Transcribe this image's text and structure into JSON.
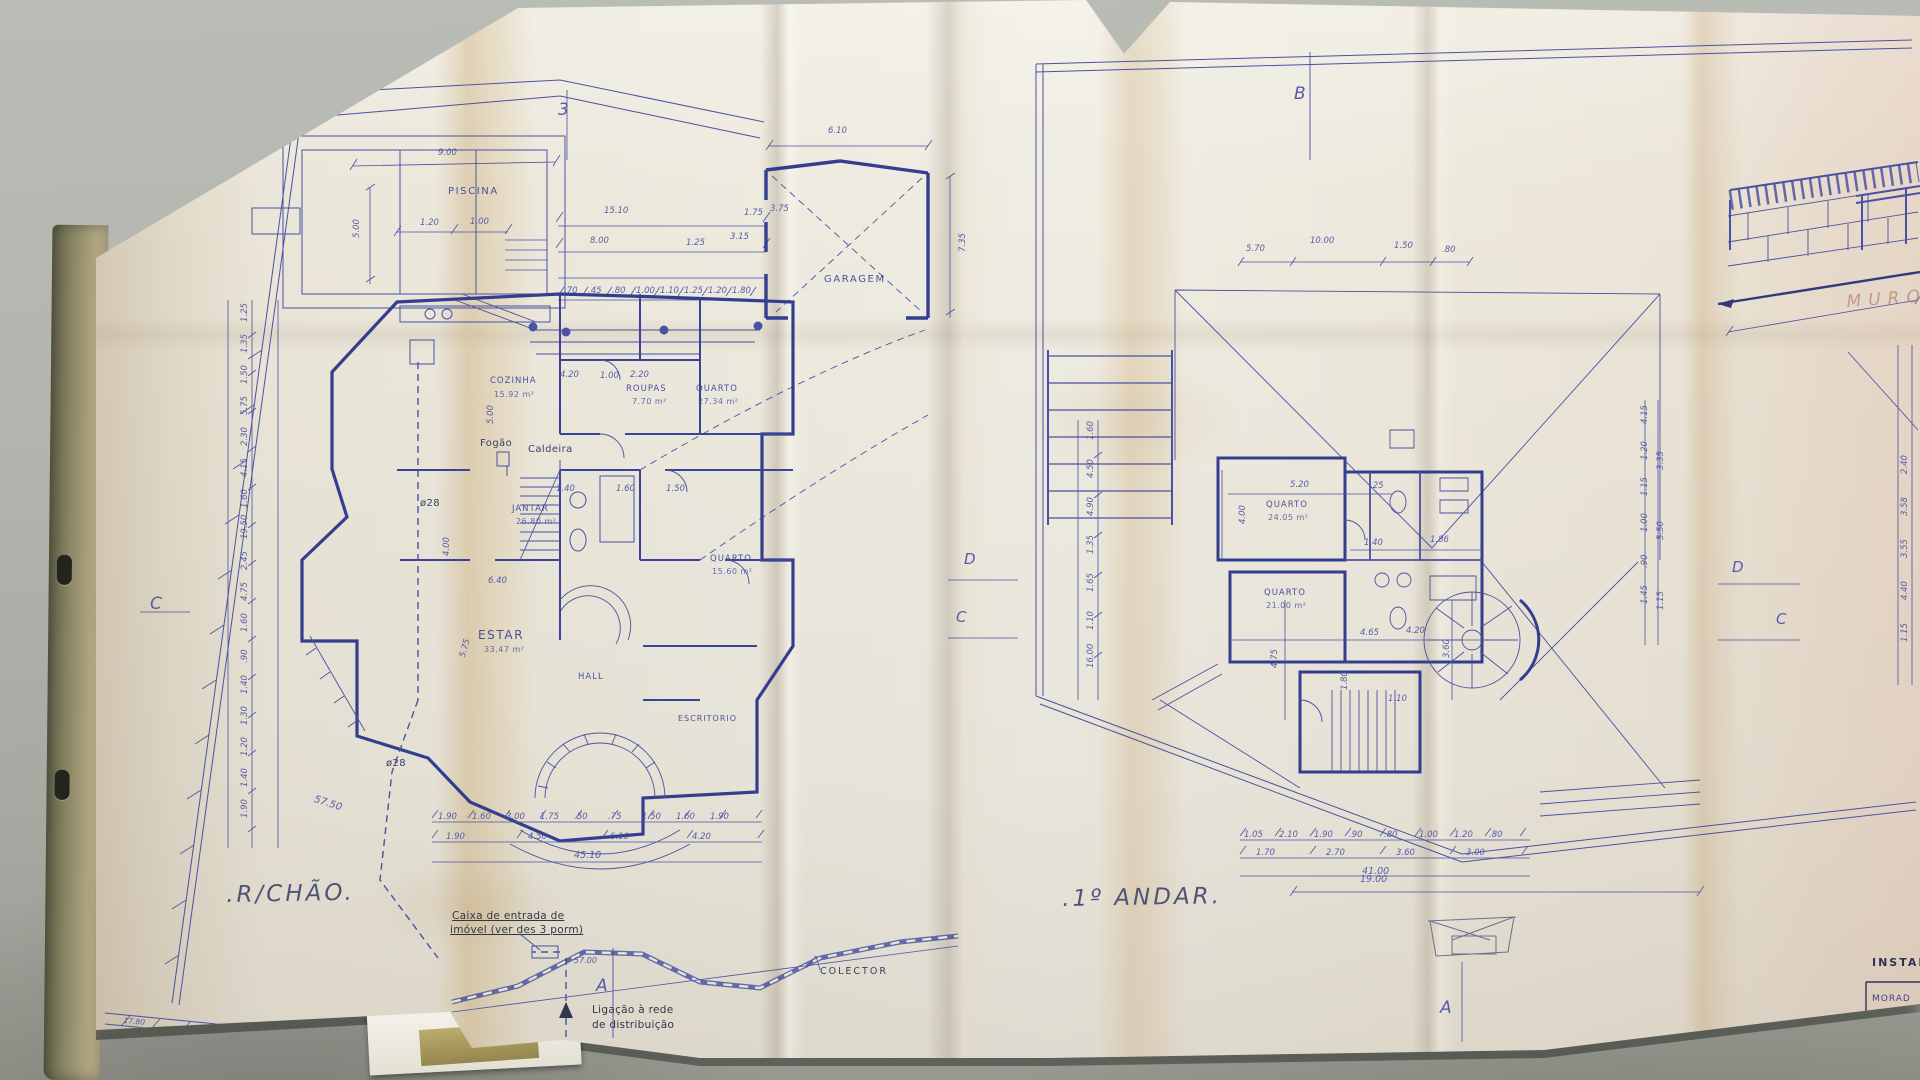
{
  "lp": {
    "title": ".R/CHÃO.",
    "m3": "3",
    "mc": "C",
    "ma": "A",
    "piscina": "PISCINA",
    "garagem": "GARAGEM",
    "cozinha": "COZINHA",
    "cozinha_a": "15.92 m²",
    "roupas": "ROUPAS",
    "roupas_a": "7.70 m²",
    "quarto": "QUARTO",
    "quarto_a": "27.34 m²",
    "quarto2": "QUARTO",
    "quarto2_a": "15.60 m²",
    "jantar": "JANTAR",
    "jantar_a": "26.80 m²",
    "estar": "ESTAR",
    "estar_a": "33.47 m²",
    "hall": "HALL",
    "escritorio": "ESCRITORIO",
    "fogao": "Fogão",
    "caldeira": "Caldeira",
    "phi28a": "ø28",
    "phi28b": "ø28",
    "d5750": "57.50",
    "d5700": "57.00",
    "colector": "COLECTOR",
    "caixa1": "Caixa de entrada de",
    "caixa2": "imóvel (ver des 3 porm)",
    "lig1": "Ligação à rede",
    "lig2": "de distribuição",
    "pool_w": "9.00",
    "pool_h": "5.00",
    "pool_c1": "1.20",
    "pool_c2": "1.00",
    "garage_w": "6.10",
    "garage_h": "7.35",
    "t1510": "15.10",
    "t800": "8.00",
    "t125": "1.25",
    "t315": "3.15",
    "t175": "1.75",
    "t375": "3.75",
    "i420": "4.20",
    "i100": "1.00",
    "i220": "2.20",
    "i400": "4.00",
    "i640": "6.40",
    "i140": "1.40",
    "i160": "1.60",
    "i150": "1.50",
    "i575": "5.75",
    "i500": "5.00",
    "total": "45.10",
    "wall": "17.80",
    "chain_left": [
      "1.25",
      "1.35",
      "1.50",
      "5.75",
      "2.30",
      "4.15",
      "1.60",
      "19.50",
      "2.45",
      "4.75",
      "1.60",
      ".90",
      "1.40",
      "1.30",
      "1.20",
      "1.40",
      "1.90"
    ],
    "chain_top": [
      ".70",
      ".45",
      ".80",
      "1.00",
      "1.10",
      "1.25",
      "1.20",
      "1.80"
    ],
    "chain_b1": [
      "1.90",
      "1.60",
      "3.00",
      "1.75",
      ".50",
      ".75",
      "1.50",
      "1.60",
      "1.90"
    ],
    "chain_b2": [
      "1.90",
      "4.50",
      "6.10",
      "4.20"
    ]
  },
  "rp": {
    "title": ".1º ANDAR.",
    "mb": "B",
    "md1": "D",
    "mc1": "C",
    "md2": "D",
    "mc2": "C",
    "ma": "A",
    "quarto1": "QUARTO",
    "quarto1_a": "24.05 m²",
    "quarto2": "QUARTO",
    "quarto2_a": "21.00 m²",
    "t570": "5.70",
    "t1000": "10.00",
    "t150": "1.50",
    "t080": ".80",
    "long": "19.00",
    "i520": "5.20",
    "i025": ".25",
    "i400": "4.00",
    "i140": "1.40",
    "i186": "1.86",
    "i465": "4.65",
    "i420": "4.20",
    "i475": "4.75",
    "i360": "3.60",
    "i180": "1.80",
    "i110": "1.10",
    "total": "41.00",
    "chain_left": [
      "1.60",
      "4.50",
      "4.90",
      "1.35",
      "1.65",
      "1.10",
      "16.00"
    ],
    "chain_r1": [
      "4.15",
      "1.20",
      "1.15",
      "1.00",
      ".90",
      "1.45"
    ],
    "chain_r2": [
      "3.35",
      "5.50",
      "1.15"
    ],
    "chain_far": [
      "2.40",
      "3.58",
      "3.55",
      "4.40",
      "1.15"
    ],
    "chain_b1": [
      "1.05",
      "2.10",
      "1.90",
      ".90",
      ".80",
      "1.00",
      "1.20",
      ".80"
    ],
    "chain_b2": [
      "1.70",
      "2.70",
      "3.60",
      "3.00"
    ]
  },
  "muro": "MURO",
  "tb": {
    "h": "INSTAL",
    "r1": "MORAD",
    "r2": "RUA",
    "r3": "P L"
  }
}
